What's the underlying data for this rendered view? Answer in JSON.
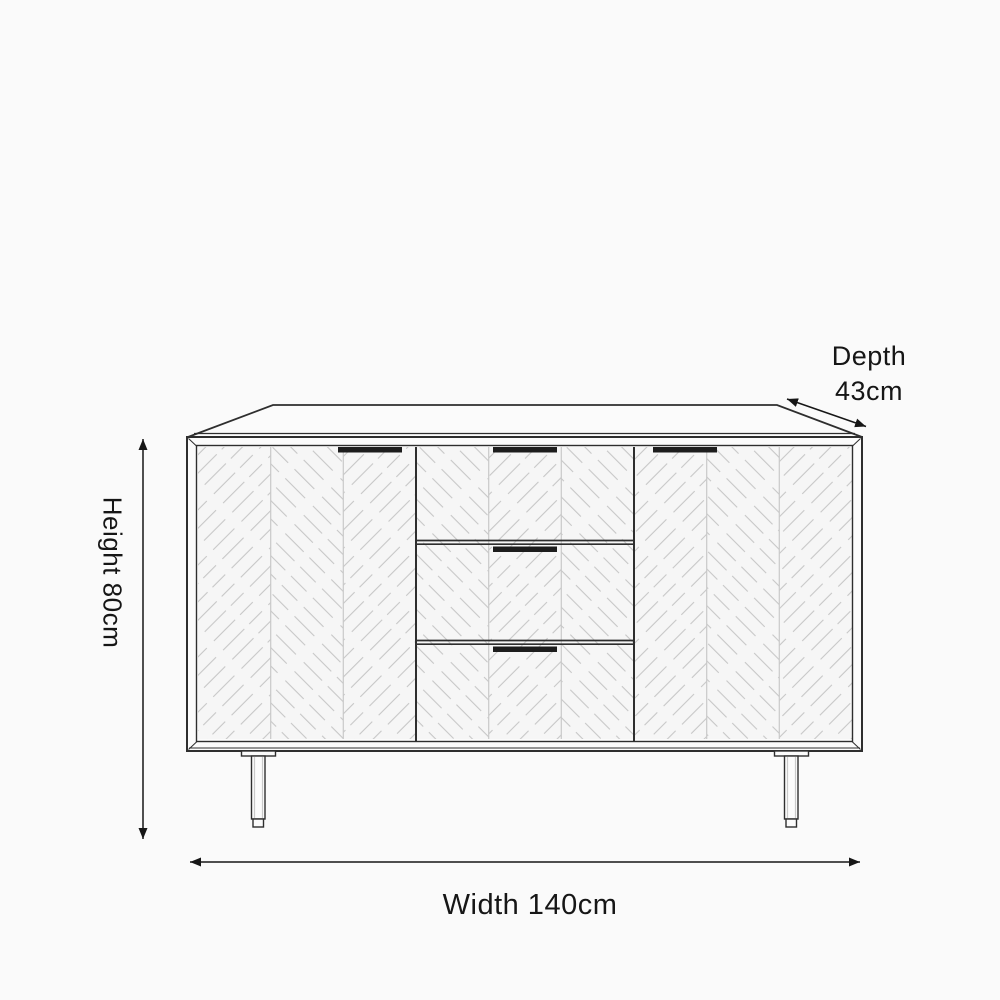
{
  "diagram": {
    "type": "furniture-dimension-drawing",
    "subject": "sideboard",
    "features": {
      "doors": 2,
      "drawers": 3,
      "door_handles": 2,
      "drawer_handles": 3,
      "legs_visible": 2,
      "front_panel_strips": 9,
      "panel_pattern": "herringbone"
    }
  },
  "dimensions": {
    "depth": {
      "label": "Depth",
      "value": "43cm",
      "value_cm": 43
    },
    "height": {
      "label": "Height",
      "text": "Height 80cm",
      "value_cm": 80
    },
    "width": {
      "label": "Width",
      "text": "Width 140cm",
      "value_cm": 140
    }
  },
  "colors": {
    "background": "#fafafa",
    "surface": "#fbfbfb",
    "panel": "#f6f6f6",
    "outline": "#2e2e2e",
    "separator": "#c9c9c9",
    "hatch": "#c7c7c7",
    "handle": "#1d1d1d",
    "dim": "#161616",
    "text": "#161616"
  }
}
